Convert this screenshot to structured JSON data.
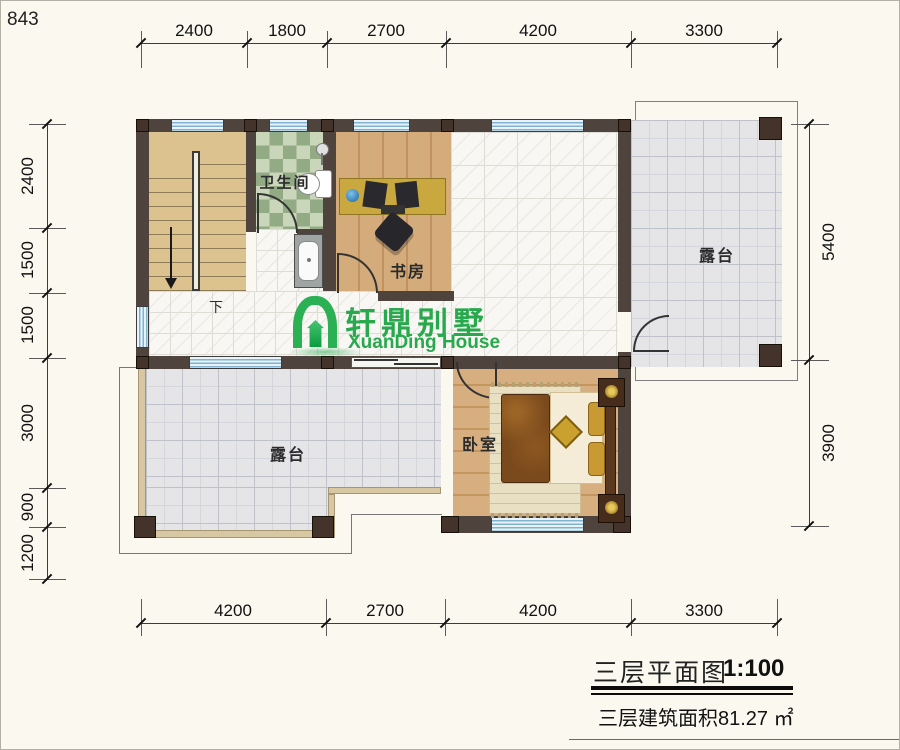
{
  "page": {
    "code": "843"
  },
  "dims": {
    "top": [
      "2400",
      "1800",
      "2700",
      "4200",
      "3300"
    ],
    "bottom": [
      "4200",
      "2700",
      "4200",
      "3300"
    ],
    "left": [
      "2400",
      "1500",
      "1500",
      "3000",
      "900",
      "1200"
    ],
    "right": [
      "5400",
      "3900"
    ]
  },
  "rooms": {
    "bathroom": "卫生间",
    "study": "书房",
    "terrace_top": "露台",
    "terrace_bottom": "露台",
    "bedroom": "卧室",
    "stair_direction": "下"
  },
  "logo": {
    "name_cn": "轩鼎别墅",
    "name_en": "XuanDing House",
    "brand_color": "#28a94d"
  },
  "title_block": {
    "title": "三层平面图",
    "scale": "1:100",
    "area_note": "三层建筑面积81.27 ㎡"
  },
  "colors": {
    "wall": "#4e433d",
    "background": "#fbf9ef",
    "terrace_tile": "#e5e5e8",
    "wood": "#d4ac7c",
    "bath_green": "#93ab85",
    "window_blue": "#7fb3d1"
  }
}
